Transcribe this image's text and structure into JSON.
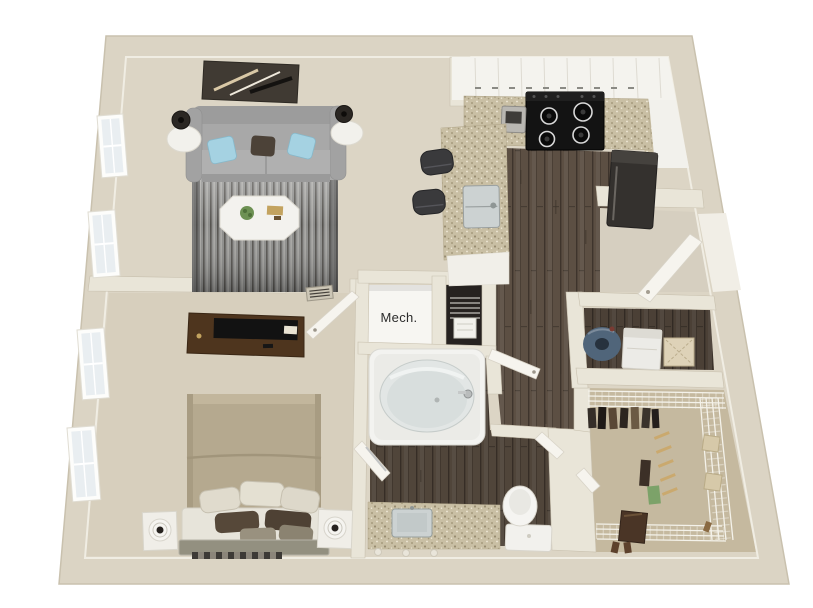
{
  "labels": {
    "mech": "Mech."
  },
  "colors": {
    "bg": "#ffffff",
    "wallRing": "#dbd4c4",
    "wall": "#e9e5d8",
    "wallEdge": "#c8c0ae",
    "carpetLiving": "#dcd5c5",
    "carpetBedroom": "#d7cfbd",
    "carpetCloset": "#c5b99f",
    "carpetEntry": "#d6cfc0",
    "wood": "#5c4f43",
    "woodLine": "#3e342c",
    "granite": "#c9bfa4",
    "graniteDot": "#a79c7e",
    "whiteSurface": "#f4f3ee",
    "sofa": "#a8a8a8",
    "pillowBlue": "#a5d2e2",
    "pillowDark": "#4c4238",
    "rugBase": "#8d8d8b",
    "rugDark": "#55534f",
    "rugLight": "#b9b8b4",
    "bedSpread": "#b5a98f",
    "headboard": "#939080",
    "dresser": "#4e351e",
    "tvBlack": "#121212",
    "applianceDark": "#34312e",
    "steel": "#ccd2d2",
    "hamperBlue": "#50657a",
    "shelfWire": "#f4f2ea",
    "doorWhite": "#f6f4ee",
    "paneBlue": "#e9eef1",
    "plantGreen": "#6d9153",
    "gold": "#c3a35f",
    "textDark": "#2b2b2b"
  },
  "rooms": [
    {
      "name": "living-room",
      "furniture": [
        "sofa",
        "accent-pillows",
        "area-rug",
        "coffee-table",
        "end-tables",
        "table-lamps",
        "wall-art",
        "windows"
      ]
    },
    {
      "name": "kitchen",
      "furniture": [
        "upper-cabinets",
        "granite-counter",
        "range-cooktop",
        "small-appliance",
        "refrigerator",
        "breakfast-bar",
        "bar-sink",
        "bar-stools"
      ]
    },
    {
      "name": "mechanical-closet",
      "furniture": [
        "water-heater-rack"
      ]
    },
    {
      "name": "bathroom",
      "furniture": [
        "bathtub",
        "vanity-sink",
        "toilet",
        "doors"
      ]
    },
    {
      "name": "bedroom",
      "furniture": [
        "bed",
        "pillows",
        "headboard",
        "nightstands",
        "lamps",
        "dresser",
        "tv",
        "runner-rug",
        "windows",
        "door",
        "vent-grille"
      ]
    },
    {
      "name": "laundry-closet",
      "furniture": [
        "hamper",
        "appliance",
        "basket"
      ]
    },
    {
      "name": "walk-in-closet",
      "furniture": [
        "wire-shelving",
        "hanging-clothes",
        "shoe-shelves",
        "storage-boxes"
      ]
    },
    {
      "name": "entry",
      "furniture": [
        "front-door"
      ]
    }
  ]
}
